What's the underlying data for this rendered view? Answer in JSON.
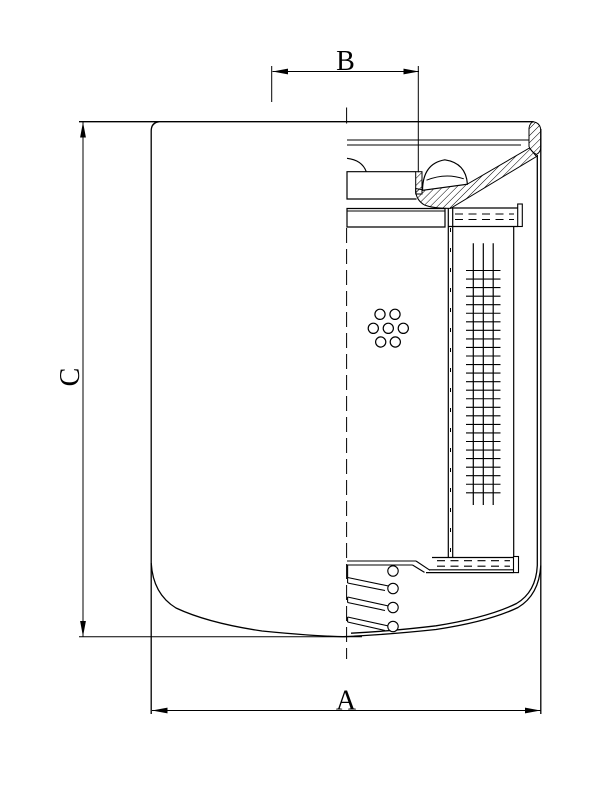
{
  "drawing": {
    "title": "filter-cartridge-cross-section",
    "dimensions": {
      "a": {
        "label": "A"
      },
      "b": {
        "label": "B"
      },
      "c": {
        "label": "C"
      }
    },
    "colors": {
      "line": "#000000",
      "background": "#ffffff"
    }
  }
}
